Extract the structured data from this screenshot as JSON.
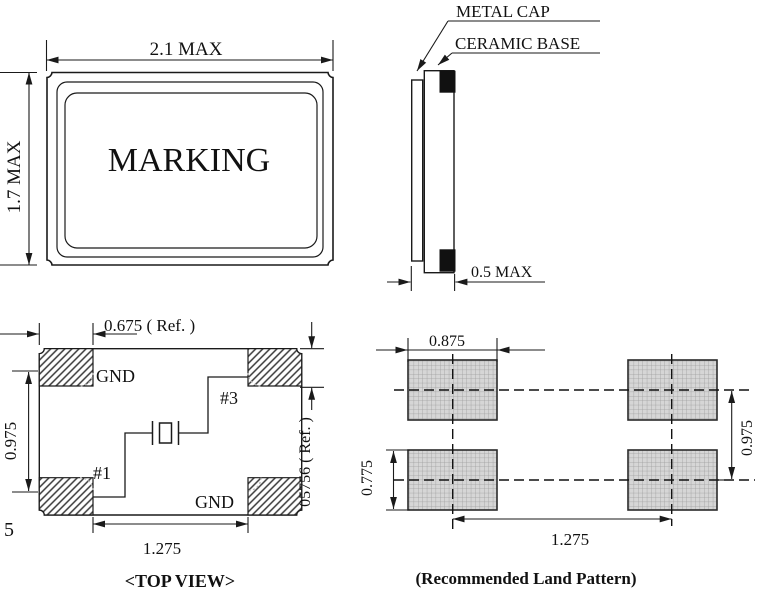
{
  "package_top": {
    "dim_width": "2.1 MAX",
    "dim_height": "1.7 MAX",
    "marking": "MARKING"
  },
  "side_view": {
    "metal_cap": "METAL CAP",
    "ceramic_base": "CERAMIC BASE",
    "dim_thickness": "0.5 MAX"
  },
  "top_view": {
    "dim_top": "0.675 ( Ref. )",
    "dim_left": "0.975",
    "dim_right": "05756 ( Ref. )",
    "dim_bottom": "1.275",
    "gnd_top": "GND",
    "pin3": "#3",
    "pin1": "#1",
    "gnd_bottom": "GND",
    "edge_note": "5",
    "caption": "<TOP VIEW>"
  },
  "land_pattern": {
    "dim_pad_width": "0.875",
    "dim_pad_height": "0.775",
    "dim_row_pitch": "0.975",
    "dim_col_pitch": "1.275",
    "caption": "(Recommended Land Pattern)"
  },
  "colors": {
    "line": "#1a1a1a",
    "pad_fill": "#d6d6d6",
    "pad_grid": "#9e9e9e",
    "black_terminal": "#111111",
    "background": "#ffffff"
  }
}
